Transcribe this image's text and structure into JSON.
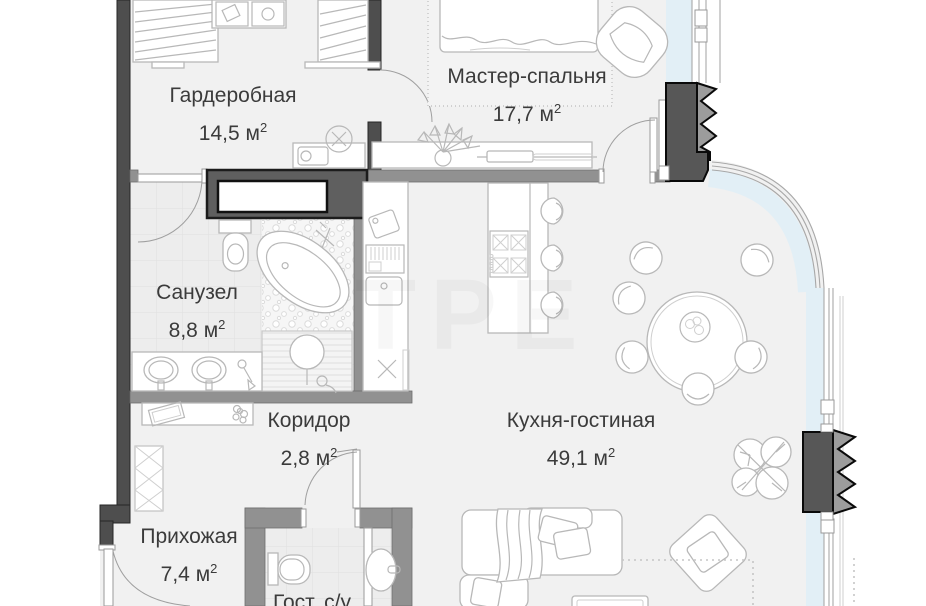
{
  "plan": {
    "title": "apartment-floor-plan",
    "watermark": "ТРЕ",
    "units": {
      "meter": "м",
      "sup": "2"
    },
    "rooms": [
      {
        "key": "wardrobe",
        "name": "Гардеробная",
        "area": "14,5"
      },
      {
        "key": "master-bedroom",
        "name": "Мастер-спальня",
        "area": "17,7"
      },
      {
        "key": "bathroom",
        "name": "Санузел",
        "area": "8,8"
      },
      {
        "key": "corridor",
        "name": "Коридор",
        "area": "2,8"
      },
      {
        "key": "kitchen-living",
        "name": "Кухня-гостиная",
        "area": "49,1"
      },
      {
        "key": "hallway",
        "name": "Прихожая",
        "area": "7,4"
      },
      {
        "key": "guest-wc",
        "name": "Гост. с/у"
      }
    ],
    "colors": {
      "wall_dark": "#4e4e4e",
      "wall_mid": "#919191",
      "floor": "#f1f1f1",
      "glazing": "#e2eff6",
      "furniture_stroke": "#b8b8b8",
      "text": "#3b3b3b"
    }
  }
}
